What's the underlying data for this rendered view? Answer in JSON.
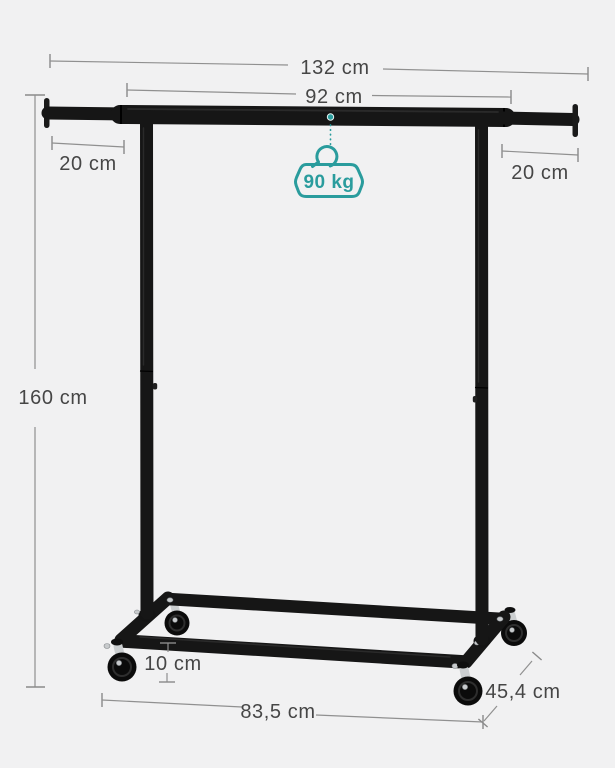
{
  "diagram": {
    "title": "clothes-rack-dimension-diagram",
    "dimensions": {
      "total_width": "132 cm",
      "hanging_width": "92 cm",
      "left_extension": "20 cm",
      "right_extension": "20 cm",
      "height": "160 cm",
      "base_rail_height": "10 cm",
      "base_length": "83,5 cm",
      "depth": "45,4 cm"
    },
    "capacity": "90 kg",
    "icons": {
      "capacity_icon": "weight-with-hanger-hook"
    },
    "colors": {
      "accent_teal": "#2a9c9d",
      "dimension_line_gray": "#909090",
      "label_text": "#464646",
      "rack_black": "#161616",
      "background": "#f1f1f2"
    }
  }
}
